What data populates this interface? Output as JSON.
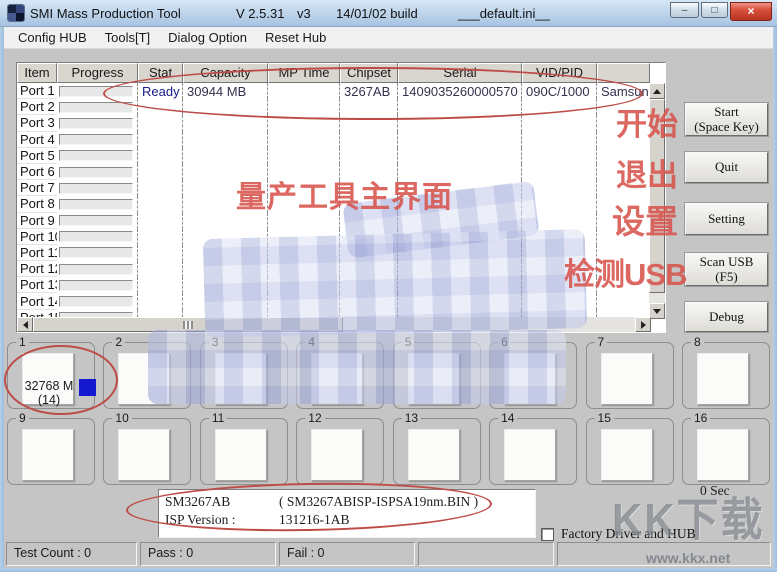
{
  "window": {
    "title": "SMI Mass Production Tool",
    "version": "V 2.5.31",
    "vtag": "v3",
    "build": "14/01/02 build",
    "ini": "___default.ini__",
    "controls": {
      "min": "–",
      "max": "□",
      "close": "×"
    }
  },
  "menu": {
    "items": [
      "Config HUB",
      "Tools[T]",
      "Dialog Option",
      "Reset Hub"
    ]
  },
  "table": {
    "columns": {
      "item": "Item",
      "progress": "Progress",
      "stat": "Stat",
      "capacity": "Capacity",
      "mp_time": "MP Time",
      "chipset": "Chipset",
      "serial": "Serial",
      "vid_pid": "VID/PID",
      "extra": ""
    },
    "rows": [
      {
        "item": "Port 1",
        "stat": "Ready",
        "capacity": "30944 MB",
        "mp_time": "",
        "chipset": "3267AB",
        "serial": "1409035260000570",
        "vid_pid": "090C/1000",
        "extra": "Samsun"
      },
      {
        "item": "Port 2",
        "stat": "",
        "capacity": "",
        "mp_time": "",
        "chipset": "",
        "serial": "",
        "vid_pid": "",
        "extra": ""
      },
      {
        "item": "Port 3",
        "stat": "",
        "capacity": "",
        "mp_time": "",
        "chipset": "",
        "serial": "",
        "vid_pid": "",
        "extra": ""
      },
      {
        "item": "Port 4",
        "stat": "",
        "capacity": "",
        "mp_time": "",
        "chipset": "",
        "serial": "",
        "vid_pid": "",
        "extra": ""
      },
      {
        "item": "Port 5",
        "stat": "",
        "capacity": "",
        "mp_time": "",
        "chipset": "",
        "serial": "",
        "vid_pid": "",
        "extra": ""
      },
      {
        "item": "Port 6",
        "stat": "",
        "capacity": "",
        "mp_time": "",
        "chipset": "",
        "serial": "",
        "vid_pid": "",
        "extra": ""
      },
      {
        "item": "Port 7",
        "stat": "",
        "capacity": "",
        "mp_time": "",
        "chipset": "",
        "serial": "",
        "vid_pid": "",
        "extra": ""
      },
      {
        "item": "Port 8",
        "stat": "",
        "capacity": "",
        "mp_time": "",
        "chipset": "",
        "serial": "",
        "vid_pid": "",
        "extra": ""
      },
      {
        "item": "Port 9",
        "stat": "",
        "capacity": "",
        "mp_time": "",
        "chipset": "",
        "serial": "",
        "vid_pid": "",
        "extra": ""
      },
      {
        "item": "Port 10",
        "stat": "",
        "capacity": "",
        "mp_time": "",
        "chipset": "",
        "serial": "",
        "vid_pid": "",
        "extra": ""
      },
      {
        "item": "Port 11",
        "stat": "",
        "capacity": "",
        "mp_time": "",
        "chipset": "",
        "serial": "",
        "vid_pid": "",
        "extra": ""
      },
      {
        "item": "Port 12",
        "stat": "",
        "capacity": "",
        "mp_time": "",
        "chipset": "",
        "serial": "",
        "vid_pid": "",
        "extra": ""
      },
      {
        "item": "Port 13",
        "stat": "",
        "capacity": "",
        "mp_time": "",
        "chipset": "",
        "serial": "",
        "vid_pid": "",
        "extra": ""
      },
      {
        "item": "Port 14",
        "stat": "",
        "capacity": "",
        "mp_time": "",
        "chipset": "",
        "serial": "",
        "vid_pid": "",
        "extra": ""
      },
      {
        "item": "Port 15",
        "stat": "",
        "capacity": "",
        "mp_time": "",
        "chipset": "",
        "serial": "",
        "vid_pid": "",
        "extra": ""
      }
    ]
  },
  "buttons": [
    {
      "label": "Start",
      "sub": "(Space Key)"
    },
    {
      "label": "Quit",
      "sub": ""
    },
    {
      "label": "Setting",
      "sub": ""
    },
    {
      "label": "Scan USB",
      "sub": "(F5)"
    },
    {
      "label": "Debug",
      "sub": ""
    }
  ],
  "annotations": {
    "main": "量产工具主界面",
    "start": "开始",
    "quit": "退出",
    "setting": "设置",
    "scan": "检测USB"
  },
  "ports_grid": {
    "slots": [
      {
        "num": "1",
        "cap": "32768 M",
        "count": "(14)",
        "blue": true
      },
      {
        "num": "2",
        "cap": "",
        "count": "",
        "blue": false
      },
      {
        "num": "3",
        "cap": "",
        "count": "",
        "blue": false
      },
      {
        "num": "4",
        "cap": "",
        "count": "",
        "blue": false
      },
      {
        "num": "5",
        "cap": "",
        "count": "",
        "blue": false
      },
      {
        "num": "6",
        "cap": "",
        "count": "",
        "blue": false
      },
      {
        "num": "7",
        "cap": "",
        "count": "",
        "blue": false
      },
      {
        "num": "8",
        "cap": "",
        "count": "",
        "blue": false
      },
      {
        "num": "9",
        "cap": "",
        "count": "",
        "blue": false
      },
      {
        "num": "10",
        "cap": "",
        "count": "",
        "blue": false
      },
      {
        "num": "11",
        "cap": "",
        "count": "",
        "blue": false
      },
      {
        "num": "12",
        "cap": "",
        "count": "",
        "blue": false
      },
      {
        "num": "13",
        "cap": "",
        "count": "",
        "blue": false
      },
      {
        "num": "14",
        "cap": "",
        "count": "",
        "blue": false
      },
      {
        "num": "15",
        "cap": "",
        "count": "",
        "blue": false
      },
      {
        "num": "16",
        "cap": "",
        "count": "",
        "blue": false
      }
    ]
  },
  "info_box": {
    "l1a": "SM3267AB",
    "l1b": "( SM3267ABISP-ISPSA19nm.BIN )",
    "l2a": "ISP Version :",
    "l2b": "131216-1AB"
  },
  "timer": "0 Sec",
  "factory_checkbox": {
    "label": "Factory Driver and HUB",
    "checked": false
  },
  "status_bar": {
    "segments": [
      "Test Count : 0",
      "Pass : 0",
      "Fail : 0",
      "",
      ""
    ]
  },
  "watermark": {
    "logo": "KK下载",
    "url": "www.kkx.net"
  },
  "colors": {
    "annotation_red": "#d8544d",
    "ellipse_red": "#bd4c47",
    "ready_blue": "#1b1b8f",
    "media_blue": "#1418cf",
    "titlebar_blue": "#bcd3ea",
    "client_gray": "#c5c5c5"
  }
}
